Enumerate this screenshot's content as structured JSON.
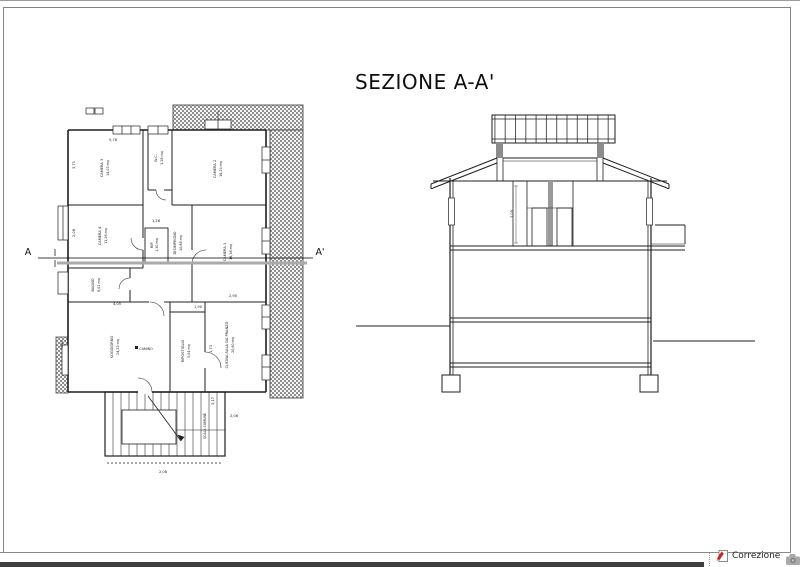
{
  "title": {
    "section_label": "SEZIONE A-A'"
  },
  "plan": {
    "section_markers": {
      "start": "A",
      "end": "A'"
    },
    "rooms": [
      {
        "name": "CAMERA 3",
        "area": "14,03 mq"
      },
      {
        "name": "CAMERA 2",
        "area": "18,23 mq"
      },
      {
        "name": "CAMERA 1",
        "area": "16,38 mq"
      },
      {
        "name": "CAMERA 4",
        "area": "11,26 mq"
      },
      {
        "name": "W.C.",
        "area": "3,28 mq"
      },
      {
        "name": "RIP.",
        "area": "1,30 mq"
      },
      {
        "name": "DISIMPEGNO",
        "area": "10,88 mq"
      },
      {
        "name": "BAGNO",
        "area": "6,02 mq"
      },
      {
        "name": "SOGGIORNO",
        "area": "24,22 mq"
      },
      {
        "name": "RIPOSTIGLIO",
        "area": "5,04 mq"
      },
      {
        "name": "CUCINA-SALA DA PRANZO",
        "area": "20,60 mq"
      },
      {
        "name": "SCALA COMUNE",
        "area": ""
      }
    ],
    "fireplace_label": "CAMINO",
    "dimensions": [
      "5,78",
      "3,71",
      "2,08",
      "1,26",
      "2,90",
      "1,90",
      "4,05",
      "4,40",
      "1,73",
      "3,17",
      "2,06",
      "2,08"
    ]
  },
  "section": {
    "height_dimension": "3,05"
  },
  "statusbar": {
    "correzione_label": "Correzione",
    "note_icon": "correction-note-icon",
    "camera_icon": "camera-icon"
  },
  "colors": {
    "line": "#1f1f1f",
    "hatch_dot": "#8f8f8f",
    "section_cut_line": "#ababab",
    "statusbar_bar": "#3f3f3f",
    "note_icon_red": "#cc2127"
  }
}
